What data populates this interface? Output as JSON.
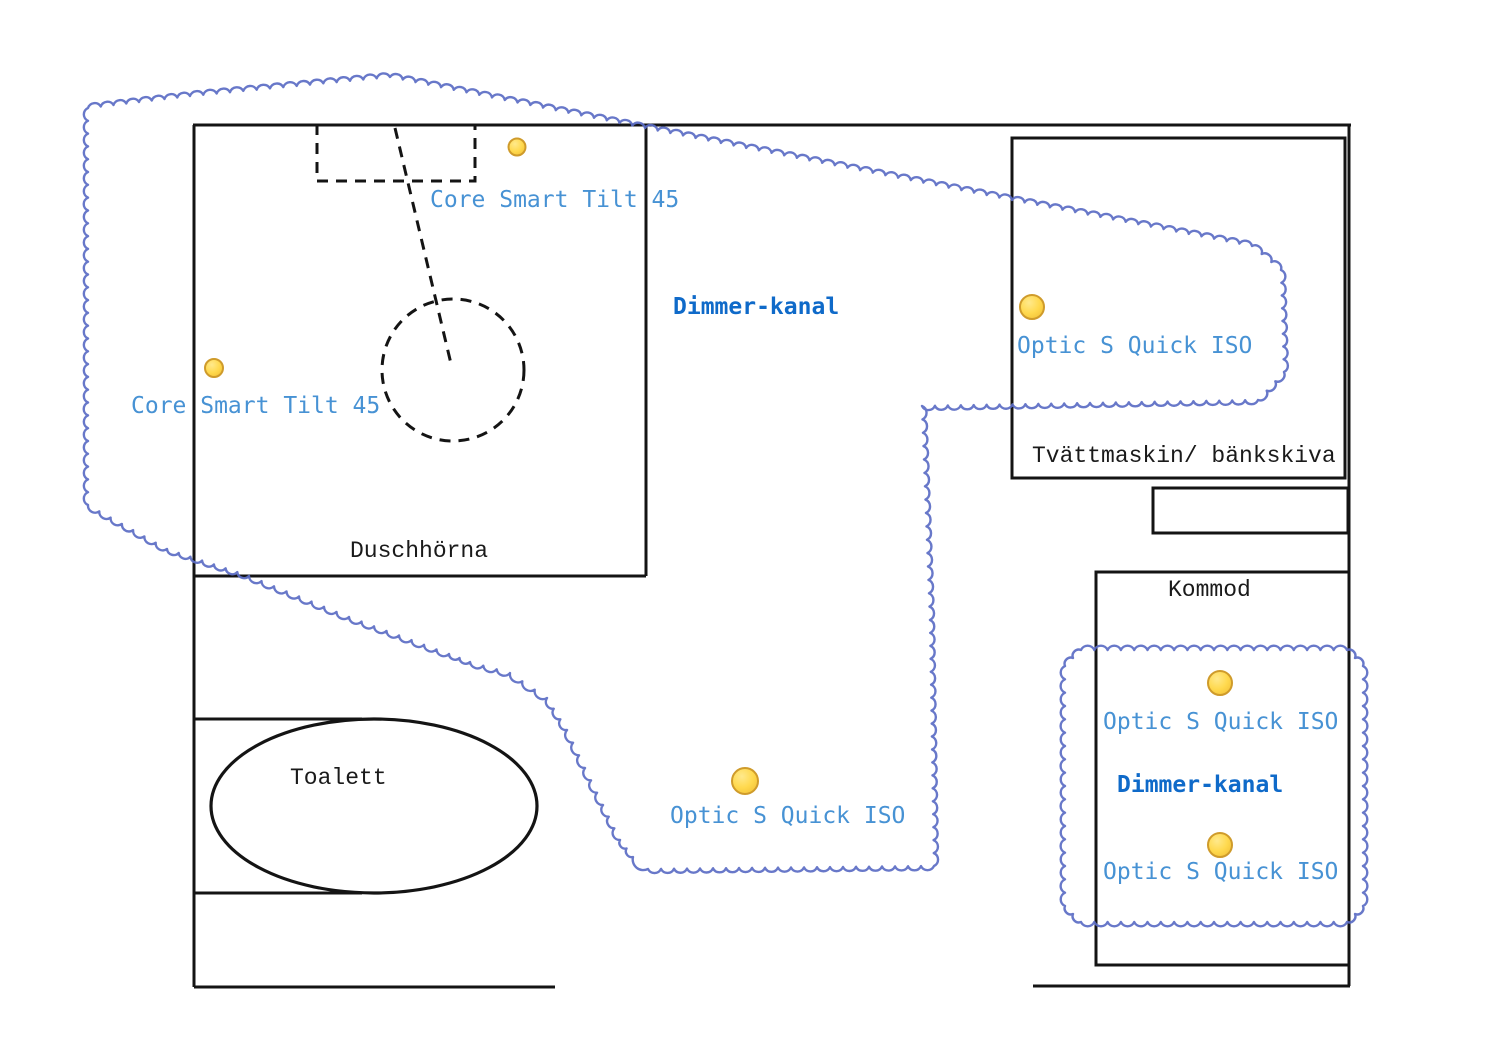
{
  "diagram": {
    "type": "floor-plan-lighting",
    "canvas": {
      "width": 1511,
      "height": 1063
    },
    "colors": {
      "wall": "#141414",
      "dashed": "#141414",
      "zone_line": "#5b6cc4",
      "label_light": "#4792d4",
      "label_bold": "#0f6ac9",
      "label_black": "#1a1a1a",
      "fixture_fill": "#ffd94e",
      "fixture_highlight": "#ffe98c",
      "fixture_edge": "#cf9b2b"
    },
    "walls": {
      "segments": [
        {
          "x1": 193,
          "y1": 125,
          "x2": 1351,
          "y2": 125
        },
        {
          "x1": 194,
          "y1": 125,
          "x2": 194,
          "y2": 987
        },
        {
          "x1": 646,
          "y1": 125,
          "x2": 646,
          "y2": 576
        },
        {
          "x1": 194,
          "y1": 576,
          "x2": 646,
          "y2": 576
        },
        {
          "x1": 194,
          "y1": 719,
          "x2": 362,
          "y2": 719
        },
        {
          "x1": 194,
          "y1": 893,
          "x2": 362,
          "y2": 893
        },
        {
          "x1": 194,
          "y1": 987,
          "x2": 555,
          "y2": 987
        },
        {
          "x1": 1349,
          "y1": 125,
          "x2": 1349,
          "y2": 986
        },
        {
          "x1": 1033,
          "y1": 986,
          "x2": 1350,
          "y2": 986
        }
      ],
      "rects": [
        {
          "name": "tvattmaskin-box",
          "x": 1012,
          "y": 138,
          "w": 333,
          "h": 340
        },
        {
          "name": "utility-box",
          "x": 1153,
          "y": 488,
          "w": 195,
          "h": 45
        },
        {
          "name": "kommod-box",
          "x": 1096,
          "y": 572,
          "w": 253,
          "h": 393
        }
      ]
    },
    "shower": {
      "dashed_rect": {
        "x": 317,
        "y": 125,
        "w": 158,
        "h": 56
      },
      "dashed_line": {
        "x1": 395,
        "y1": 128,
        "x2": 452,
        "y2": 368
      },
      "dashed_circle": {
        "cx": 453,
        "cy": 370,
        "r": 71
      }
    },
    "toilet_ellipse": {
      "cx": 374,
      "cy": 806,
      "rx": 163,
      "ry": 87
    },
    "zones": [
      {
        "name": "dimmer-zone-main",
        "points": [
          [
            88,
            108
          ],
          [
            190,
            96
          ],
          [
            390,
            77
          ],
          [
            645,
            128
          ],
          [
            1012,
            200
          ],
          [
            1252,
            246
          ],
          [
            1281,
            270
          ],
          [
            1284,
            372
          ],
          [
            1258,
            400
          ],
          [
            922,
            406
          ],
          [
            930,
            620
          ],
          [
            934,
            866
          ],
          [
            648,
            869
          ],
          [
            633,
            857
          ],
          [
            620,
            840
          ],
          [
            603,
            805
          ],
          [
            585,
            768
          ],
          [
            567,
            730
          ],
          [
            547,
            698
          ],
          [
            510,
            673
          ],
          [
            470,
            662
          ],
          [
            449,
            654
          ],
          [
            349,
            617
          ],
          [
            249,
            576
          ],
          [
            167,
            549
          ],
          [
            88,
            505
          ]
        ]
      },
      {
        "name": "dimmer-zone-kommod",
        "points": [
          [
            1081,
            650
          ],
          [
            1347,
            650
          ],
          [
            1363,
            666
          ],
          [
            1363,
            906
          ],
          [
            1347,
            922
          ],
          [
            1081,
            922
          ],
          [
            1065,
            906
          ],
          [
            1065,
            666
          ]
        ]
      }
    ],
    "fixtures": [
      {
        "model": "Core Smart Tilt 45",
        "x": 517,
        "y": 147,
        "r": 8.5
      },
      {
        "model": "Core Smart Tilt 45",
        "x": 214,
        "y": 368,
        "r": 9
      },
      {
        "model": "Optic S Quick ISO",
        "x": 1032,
        "y": 307,
        "r": 12
      },
      {
        "model": "Optic S Quick ISO",
        "x": 745,
        "y": 781,
        "r": 13
      },
      {
        "model": "Optic S Quick ISO",
        "x": 1220,
        "y": 683,
        "r": 12
      },
      {
        "model": "Optic S Quick ISO",
        "x": 1220,
        "y": 845,
        "r": 12
      }
    ],
    "labels": [
      {
        "text": "Core Smart Tilt 45",
        "x": 430,
        "y": 200,
        "style": "light"
      },
      {
        "text": "Core Smart Tilt 45",
        "x": 131,
        "y": 406,
        "style": "light"
      },
      {
        "text": "Dimmer-kanal",
        "x": 673,
        "y": 307,
        "style": "bold"
      },
      {
        "text": "Optic S Quick ISO",
        "x": 1017,
        "y": 346,
        "style": "light"
      },
      {
        "text": "Tvättmaskin/ bänkskiva",
        "x": 1032,
        "y": 456,
        "style": "black"
      },
      {
        "text": "Kommod",
        "x": 1168,
        "y": 590,
        "style": "black"
      },
      {
        "text": "Optic S Quick ISO",
        "x": 1103,
        "y": 722,
        "style": "light"
      },
      {
        "text": "Dimmer-kanal",
        "x": 1117,
        "y": 785,
        "style": "bold"
      },
      {
        "text": "Optic S Quick ISO",
        "x": 1103,
        "y": 872,
        "style": "light"
      },
      {
        "text": "Optic S Quick ISO",
        "x": 670,
        "y": 816,
        "style": "light"
      },
      {
        "text": "Toalett",
        "x": 290,
        "y": 778,
        "style": "black"
      },
      {
        "text": "Duschhörna",
        "x": 350,
        "y": 551,
        "style": "black"
      }
    ]
  }
}
